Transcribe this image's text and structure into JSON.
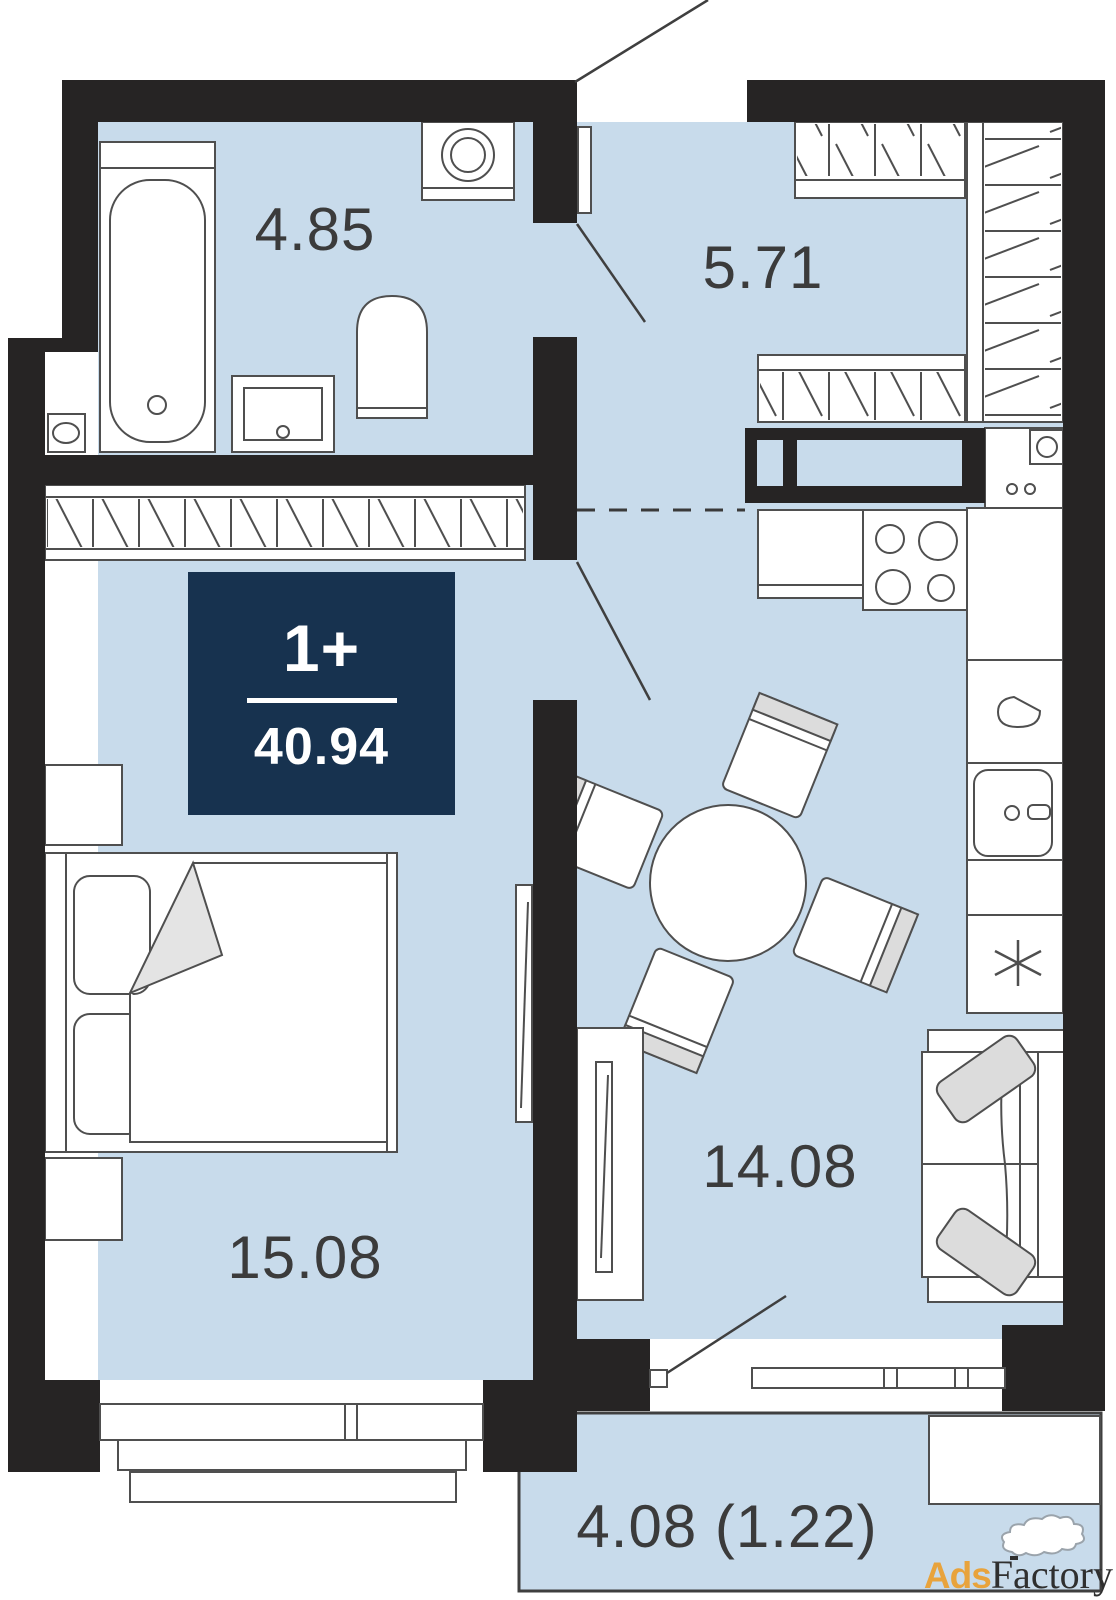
{
  "plan": {
    "type": "apartment-floor-plan",
    "rooms": {
      "bathroom": {
        "name": "bathroom",
        "area_label": "4.85"
      },
      "hallway": {
        "name": "hallway",
        "area_label": "5.71"
      },
      "bedroom": {
        "name": "bedroom",
        "area_label": "15.08"
      },
      "kitchen_living": {
        "name": "kitchen-living-room",
        "area_label": "14.08"
      },
      "balcony": {
        "name": "balcony",
        "area_label": "4.08 (1.22)"
      }
    },
    "badge": {
      "rooms_label": "1+",
      "total_area": "40.94"
    },
    "furniture_icons": [
      "bathtub",
      "washing-machine",
      "bathroom-sink",
      "toilet",
      "water-meter-box",
      "wardrobe-hall-top",
      "wardrobe-hall-right",
      "wardrobe-hall-bottom",
      "wardrobe-bedroom-wall",
      "ventilation-shaft",
      "kitchen-corner-unit",
      "kitchen-counter",
      "stove",
      "kitchen-sink",
      "kettle",
      "refrigerator",
      "dining-table",
      "chair",
      "sofa",
      "sofa-cushion",
      "bed",
      "pillow",
      "nightstand",
      "tv-bedroom",
      "tv-stand-living",
      "window",
      "balcony-bench",
      "entrance-door-swing",
      "bathroom-door-leaf",
      "door-swing",
      "balcony-door-swing",
      "zone-divider-dashed"
    ]
  },
  "watermark": {
    "prefix": "Ads",
    "suffix": "Factory"
  },
  "colors": {
    "wall": "#262424",
    "floor": "#c8dbeb",
    "outline": "#4f4f4f",
    "furniture_gray": "#dcdcdc",
    "badge_background": "#17324f",
    "badge_text": "#ffffff",
    "label_text": "#3b3b3b",
    "watermark_orange": "#e8a33c",
    "watermark_dark": "#2f2f2f"
  }
}
